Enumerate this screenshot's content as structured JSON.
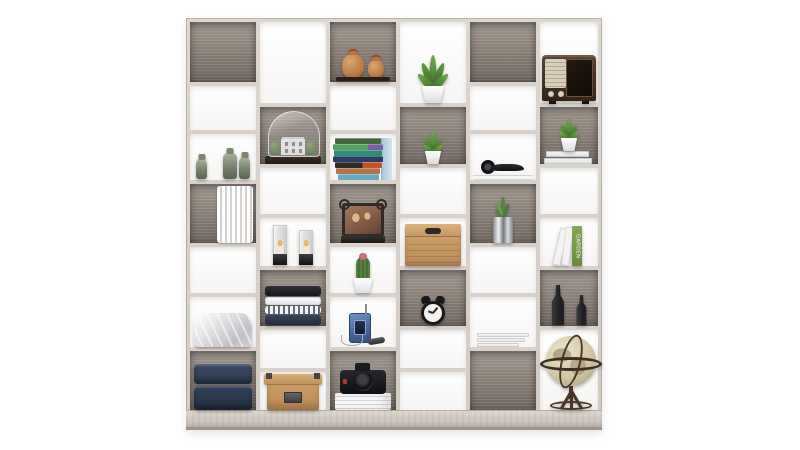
{
  "scene": {
    "type": "product-photo",
    "subject": "staggered checkerboard cube bookshelf with decorative items",
    "background_color": "#ffffff"
  },
  "palette": {
    "frame_wood": "#d9d2ca",
    "plinth_wood": "#d2cbc3",
    "back_panel_gray_light": "#a29991",
    "back_panel_gray_dark": "#6e665f",
    "white_compartment": "#ffffff",
    "kraft_box_tan": "#c79a63",
    "plant_green": "#5d9b3c",
    "radio_walnut": "#3a2a1d",
    "jeans_navy": "#2c3a50",
    "terracotta": "#b5773f"
  },
  "shelf": {
    "columns": 6,
    "compartments": 41,
    "pattern": "alternating gray wood-grain and white backs"
  },
  "texts": {
    "garden_book_spine": "GARDEN"
  },
  "items": [
    {
      "cell": "c1r3",
      "name": "green-glass-candle-holders"
    },
    {
      "cell": "c1r4",
      "name": "white-pleated-paper-decor"
    },
    {
      "cell": "c1r6",
      "name": "folded-white-duvet"
    },
    {
      "cell": "c1r7",
      "name": "folded-blue-jeans"
    },
    {
      "cell": "c2r2",
      "name": "glass-dome-miniature-house"
    },
    {
      "cell": "c2r4",
      "name": "glass-hurricane-candles"
    },
    {
      "cell": "c2r5",
      "name": "folded-shirts-stack"
    },
    {
      "cell": "c2r7",
      "name": "kraft-storage-box-with-lid"
    },
    {
      "cell": "c3r1",
      "name": "terracotta-jugs-on-tray"
    },
    {
      "cell": "c3r3",
      "name": "colorful-book-stack"
    },
    {
      "cell": "c3r4",
      "name": "family-photo-frame"
    },
    {
      "cell": "c3r5",
      "name": "cactus-in-white-pot"
    },
    {
      "cell": "c3r6",
      "name": "blue-cassette-player-with-mic"
    },
    {
      "cell": "c3r7",
      "name": "dslr-camera-on-magazines"
    },
    {
      "cell": "c4r1",
      "name": "agave-plant-white-pot"
    },
    {
      "cell": "c4r2",
      "name": "small-succulent-white-pot"
    },
    {
      "cell": "c4r4",
      "name": "kraft-box-with-handle"
    },
    {
      "cell": "c4r5",
      "name": "twin-bell-alarm-clock"
    },
    {
      "cell": "c5r3",
      "name": "headphones-on-magazines"
    },
    {
      "cell": "c5r4",
      "name": "plant-in-chrome-pot"
    },
    {
      "cell": "c5r6",
      "name": "white-book-stack"
    },
    {
      "cell": "c6r1",
      "name": "vintage-wooden-radio"
    },
    {
      "cell": "c6r2",
      "name": "succulent-on-white-books"
    },
    {
      "cell": "c6r4",
      "name": "leaning-books-garden"
    },
    {
      "cell": "c6r5",
      "name": "dark-bottle-sculptures"
    },
    {
      "cell": "c6r6",
      "name": "antique-globe-on-stand"
    }
  ]
}
